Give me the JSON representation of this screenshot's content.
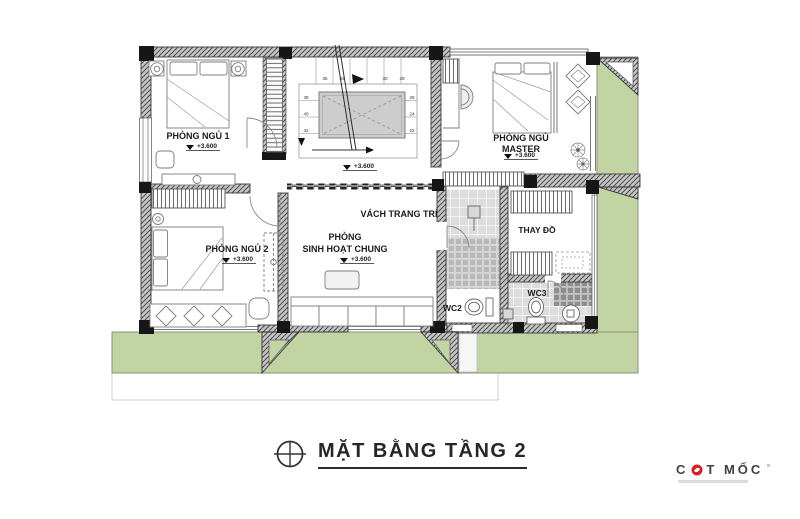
{
  "canvas": {
    "width": 800,
    "height": 519
  },
  "title": {
    "text": "MẶT BẰNG TẦNG 2"
  },
  "logo": {
    "prefix": "C",
    "suffix": "T MỐC"
  },
  "rooms": {
    "bedroom1": {
      "name": "PHÒNG NGỦ 1",
      "level": "+3.600"
    },
    "master": {
      "line1": "PHÒNG NGỦ",
      "line2": "MASTER",
      "level": "+3.600"
    },
    "bedroom2": {
      "name": "PHÒNG NGỦ 2",
      "level": "+3.600"
    },
    "living": {
      "line1": "PHÒNG",
      "line2": "SINH HOẠT CHUNG",
      "level": "+3.600"
    },
    "dressing": {
      "name": "THAY ĐỒ"
    },
    "wc2": {
      "name": "WC2"
    },
    "wc3": {
      "name": "WC3"
    }
  },
  "annotations": {
    "decor_wall": "VÁCH TRANG TRÍ",
    "stair_level": "+3.600"
  },
  "stairs": {
    "top": [
      "36",
      "34",
      "30",
      "28"
    ],
    "left": [
      "38",
      "40",
      "42"
    ],
    "right": [
      "26",
      "24",
      "22"
    ]
  },
  "colors": {
    "landscape_green": "#c3d4a4",
    "wall_fill": "#c6c6c6",
    "accent_red": "#d2232a"
  }
}
